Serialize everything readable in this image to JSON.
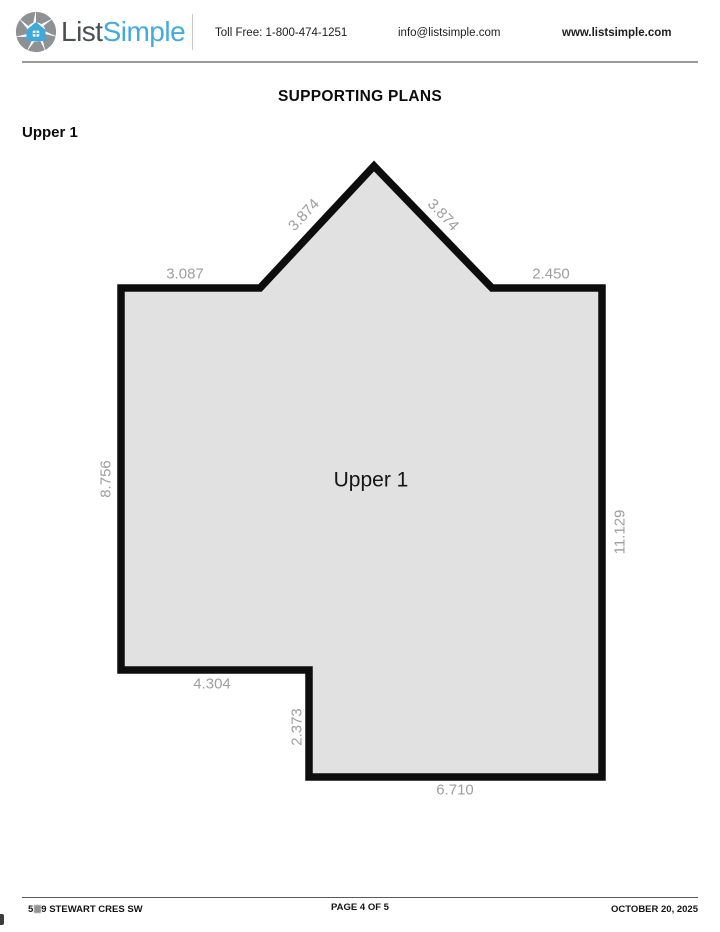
{
  "header": {
    "logo": {
      "word1": "List",
      "word2": "Simple",
      "word1_color": "#4b4e53",
      "word2_color": "#44abdd",
      "icon": "aperture-house-icon"
    },
    "toll_free": "Toll Free: 1-800-474-1251",
    "email": "info@listsimple.com",
    "website": "www.listsimple.com"
  },
  "title": "SUPPORTING PLANS",
  "section_label": "Upper 1",
  "floor_plan": {
    "room_label": "Upper 1",
    "outline_points": "121,288 260,288 374,166 492,288 602,288 602,777 309,777 309,670 121,670",
    "fill_color": "#e1e1e1",
    "outline_color": "#0d0d0d",
    "dimension_color": "#9e9e9e",
    "dimensions": {
      "top_left_edge": "3.087",
      "roof_left_edge": "3.874",
      "roof_right_edge": "3.874",
      "top_right_edge": "2.450",
      "left_edge": "8.756",
      "right_edge": "11.129",
      "notch_bottom_edge": "4.304",
      "notch_side_edge": "2.373",
      "bottom_edge": "6.710"
    }
  },
  "footer": {
    "address_start": "5",
    "address_end": "9 STEWART CRES SW",
    "page_indicator": "PAGE 4 OF 5",
    "date": "OCTOBER 20, 2025"
  }
}
